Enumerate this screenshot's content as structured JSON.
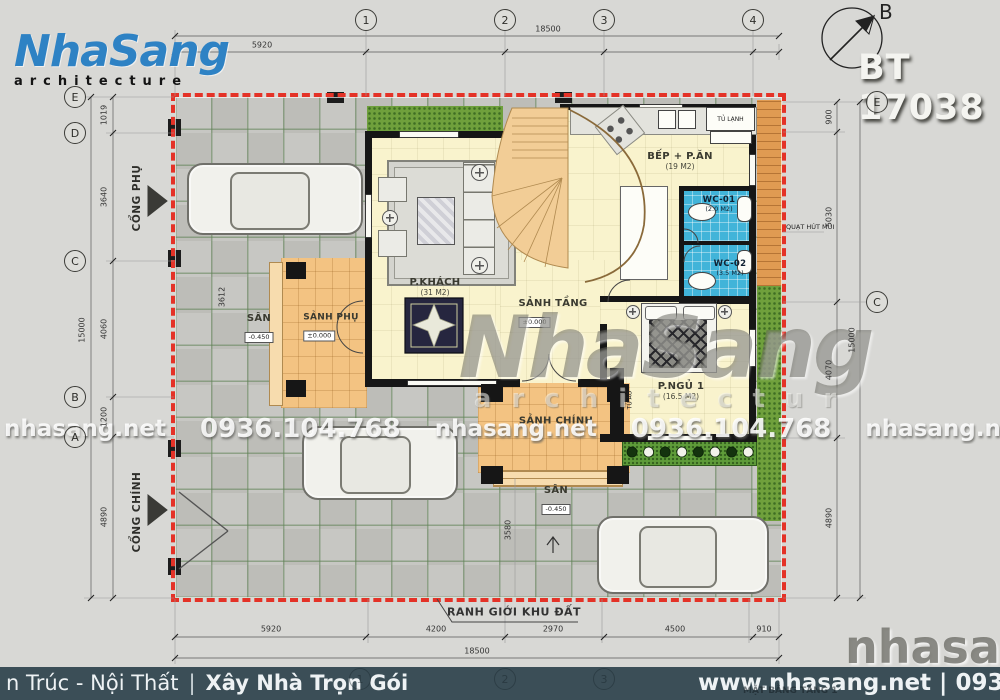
{
  "header": {
    "logo_name": "NhaSang",
    "logo_sub": "architecture",
    "project_code": "BT 17038",
    "north_label": "B"
  },
  "colors": {
    "logo_blue": "#2e82c4",
    "boundary_red": "#e43227",
    "wc_blue": "#41b4d9",
    "grass_green": "#6fa03c",
    "porch_orange": "#f3c382",
    "interior_cream": "#f9f3cd",
    "footer_bar": "#3b4e57"
  },
  "grid": {
    "top": [
      "1",
      "2",
      "3",
      "4"
    ],
    "left": [
      "E",
      "D",
      "C",
      "B",
      "A"
    ],
    "right": [
      "E",
      "C"
    ],
    "bottom": [
      "1",
      "2",
      "3"
    ]
  },
  "dimensions": {
    "top": {
      "total": "18500",
      "segment": "5920"
    },
    "bottom": {
      "segments": [
        "5920",
        "4200",
        "2970",
        "4500",
        "910"
      ],
      "total": "18500"
    },
    "left": {
      "segments": [
        "1019",
        "3640",
        "4060",
        "1200",
        "4890"
      ],
      "total": "15000"
    },
    "right": {
      "segments": [
        "900",
        "5030",
        "4070",
        "4890"
      ],
      "total": "15000"
    },
    "yard": {
      "left_width": "3612",
      "court_width": "3580"
    }
  },
  "site": {
    "boundary_label": "RANH GIỚI KHU ĐẤT",
    "gate_side": "CỔNG PHỤ",
    "gate_main": "CỔNG CHÍNH",
    "exhaust_label": "QUẠT HÚT MÙI",
    "yard_left": {
      "label": "SÂN",
      "level": "-0.450"
    },
    "yard_front": {
      "label": "SÂN",
      "level": "-0.450"
    }
  },
  "rooms": {
    "living": {
      "name": "P.KHÁCH",
      "area": "(31 M2)"
    },
    "kitchen": {
      "name": "BẾP + P.ĂN",
      "area": "(19 M2)"
    },
    "wc1": {
      "name": "WC-01",
      "area": "(2.0 M2)"
    },
    "wc2": {
      "name": "WC-02",
      "area": "(3.5 M2)"
    },
    "bedroom": {
      "name": "P.NGỦ 1",
      "area": "(16.5 M2)"
    },
    "hall": {
      "name": "SẢNH TẦNG",
      "level": "±0.000"
    },
    "porch_main": {
      "name": "SẢNH CHÍNH"
    },
    "porch_side": {
      "name": "SẢNH PHỤ",
      "level": "±0.000"
    },
    "fridge": "TỦ LẠNH",
    "wardrobe": "TỦ ÁO"
  },
  "watermarks": {
    "tile_name": "nhasang.net",
    "tile_phone": "0936.104.768",
    "center_name": "NhaSang",
    "center_sub": "architectur",
    "corner": "nhasang.ne"
  },
  "footer": {
    "left_prefix": "n Trúc - Nội Thất",
    "separator": "|",
    "left_bold": "Xây Nhà Trọn Gói",
    "right": "www.nhasang.net | 0936.104.768",
    "plan_title": "MẶT BẰNG TẦNG 1"
  }
}
